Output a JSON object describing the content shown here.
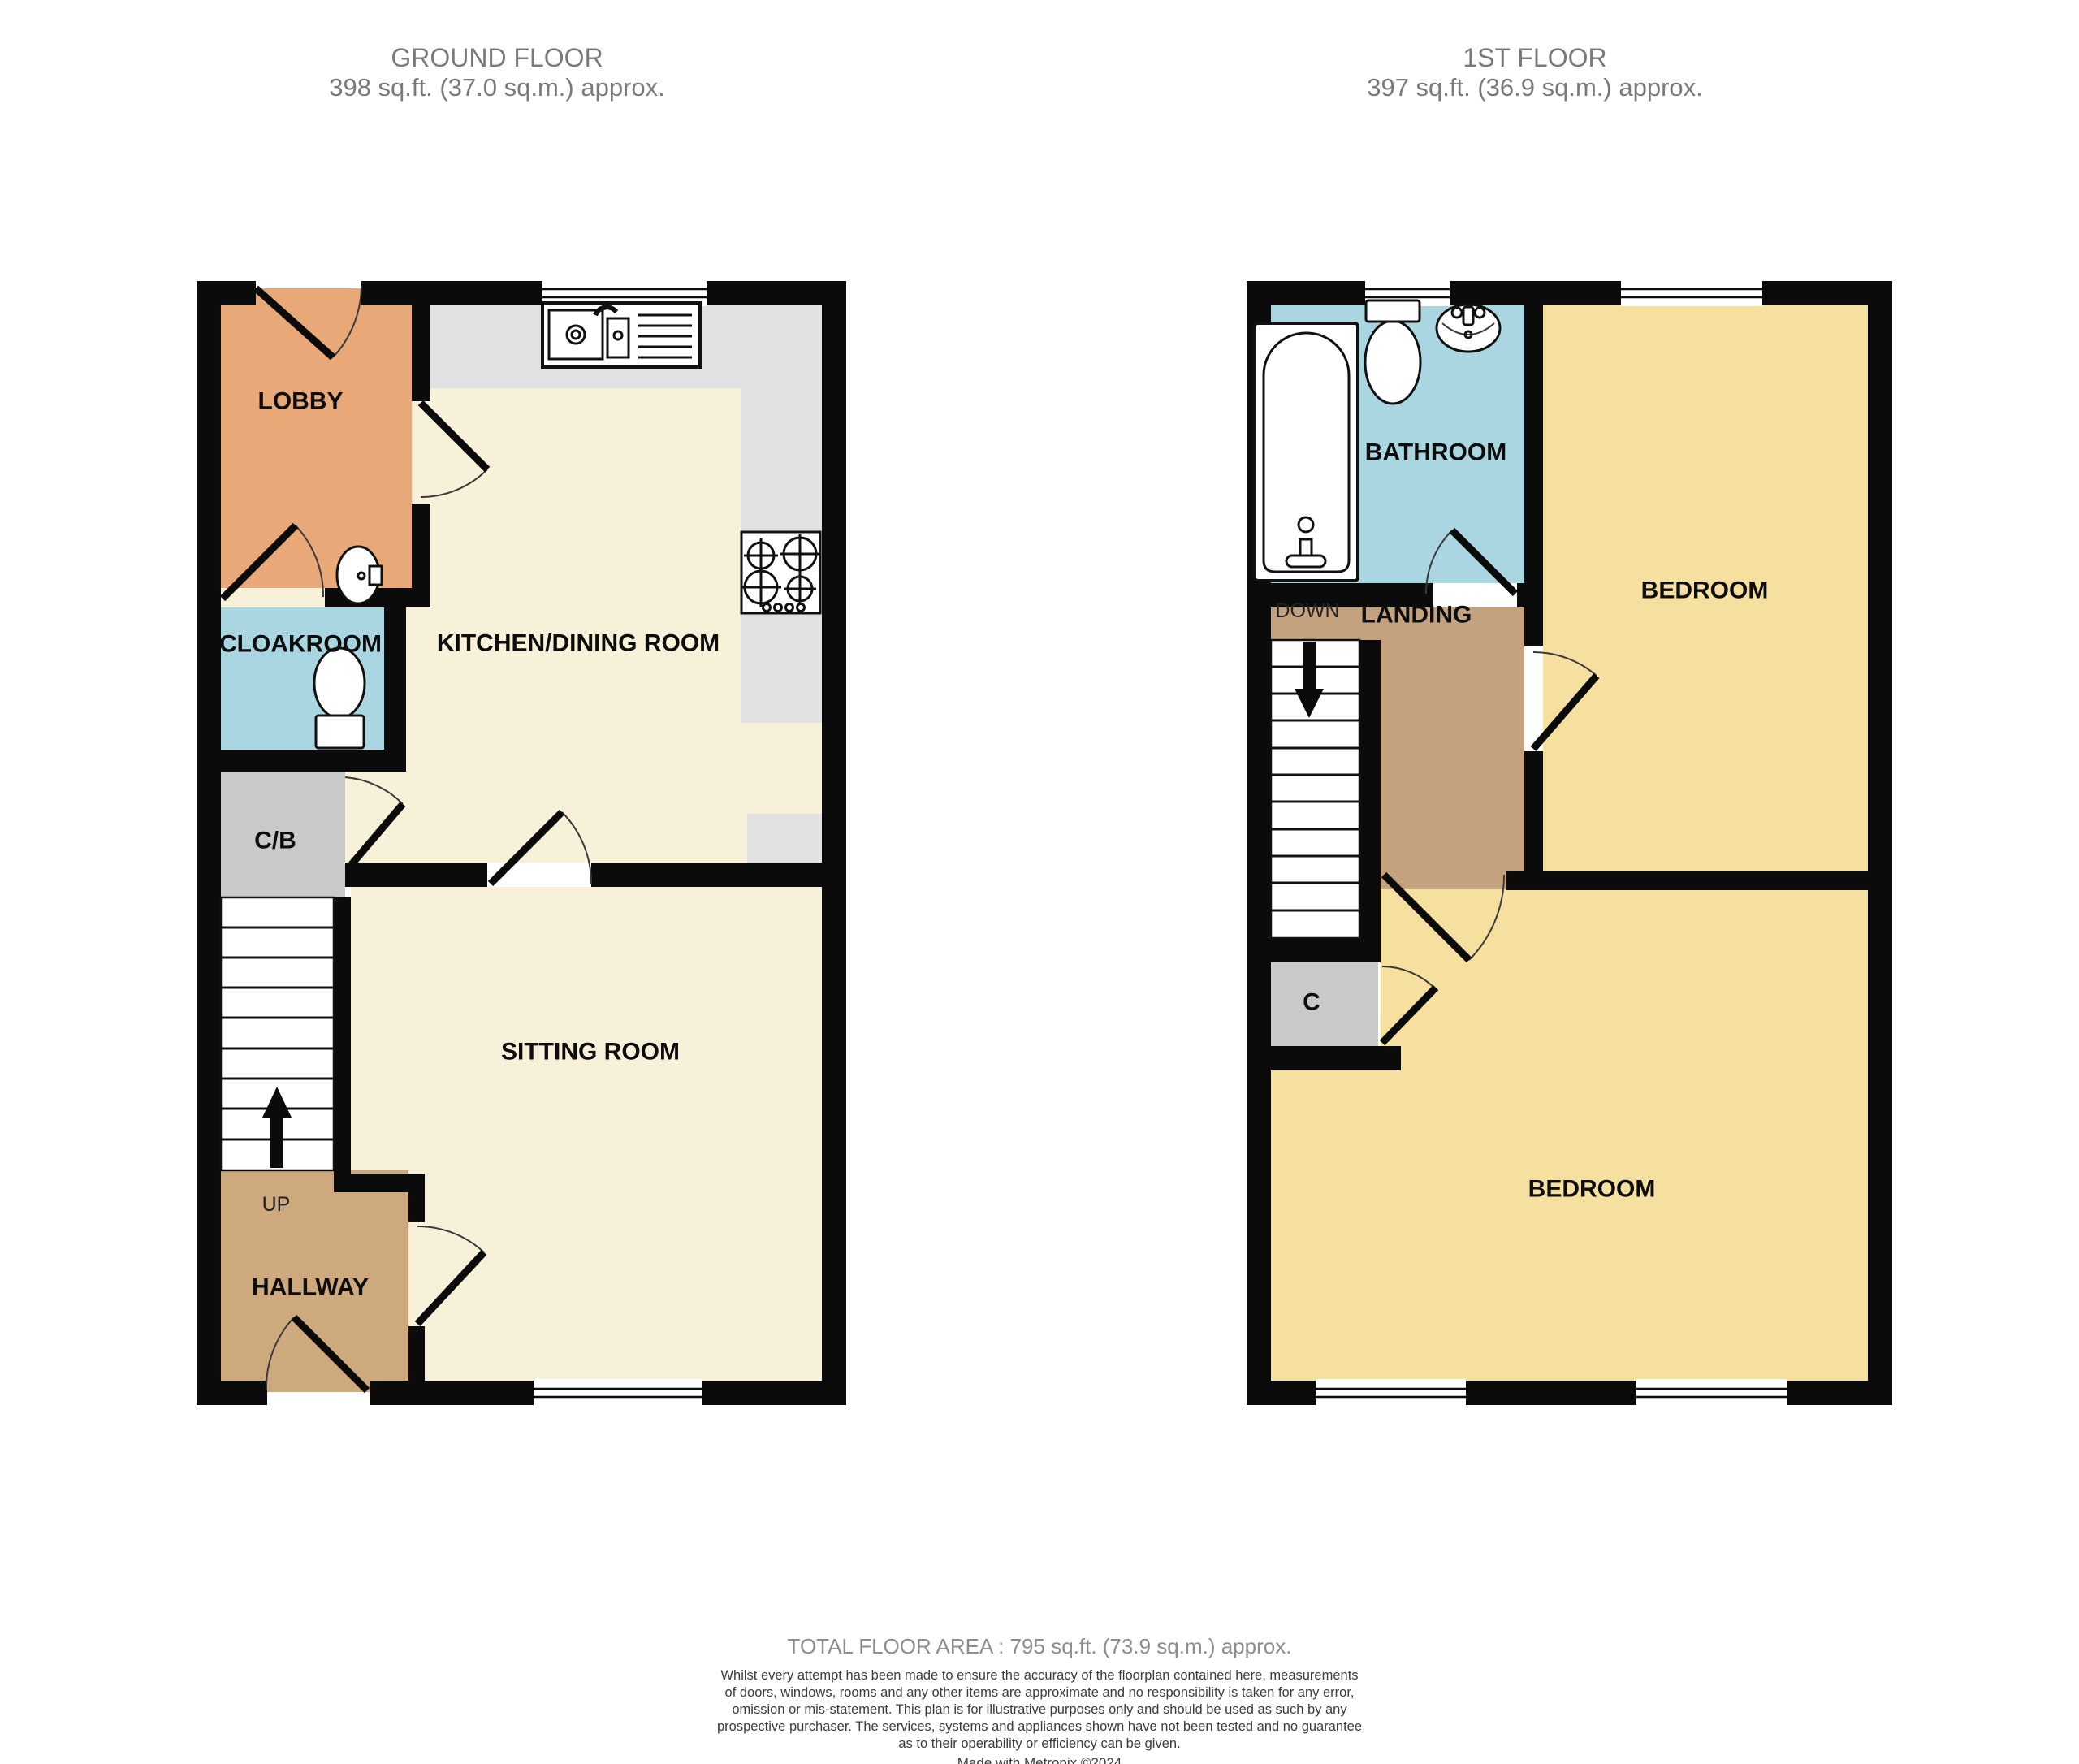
{
  "ground_floor": {
    "title": "GROUND FLOOR",
    "area": "398 sq.ft. (37.0 sq.m.) approx.",
    "rooms": {
      "lobby": "LOBBY",
      "cloakroom": "CLOAKROOM",
      "kitchen_dining": "KITCHEN/DINING ROOM",
      "cupboard": "C/B",
      "sitting_room": "SITTING ROOM",
      "hallway": "HALLWAY",
      "stairs_direction": "UP"
    }
  },
  "first_floor": {
    "title": "1ST FLOOR",
    "area": "397 sq.ft. (36.9 sq.m.) approx.",
    "rooms": {
      "bathroom": "BATHROOM",
      "bedroom_front": "BEDROOM",
      "landing": "LANDING",
      "stairs_direction": "DOWN",
      "cupboard": "C",
      "bedroom_back": "BEDROOM"
    }
  },
  "footer": {
    "total_area": "TOTAL FLOOR AREA : 795 sq.ft. (73.9 sq.m.) approx.",
    "disclaimer_lines": [
      "Whilst every attempt has been made to ensure the accuracy of the floorplan contained here, measurements",
      "of doors, windows, rooms and any other items are approximate and no responsibility is taken for any error,",
      "omission or mis-statement. This plan is for illustrative purposes only and should be used as such by any",
      "prospective purchaser. The services, systems and appliances shown have not been tested and no guarantee",
      "as to their operability or efficiency can be given."
    ],
    "credit": "Made with Metropix ©2024"
  },
  "colors": {
    "wall": "#0b0b0b",
    "kitchen_sitting": "#F8F1DA",
    "lobby": "#E8A878",
    "cloakroom_bathroom": "#AAD6E1",
    "bedrooms": "#F5E0A0",
    "hallway": "#CEA97E",
    "landing": "#C4A280",
    "cupboards": "#C9C9C9",
    "counters": "#E1E1E1",
    "header_text": "#7a7a7a",
    "footer_text": "#3c3c3c"
  }
}
